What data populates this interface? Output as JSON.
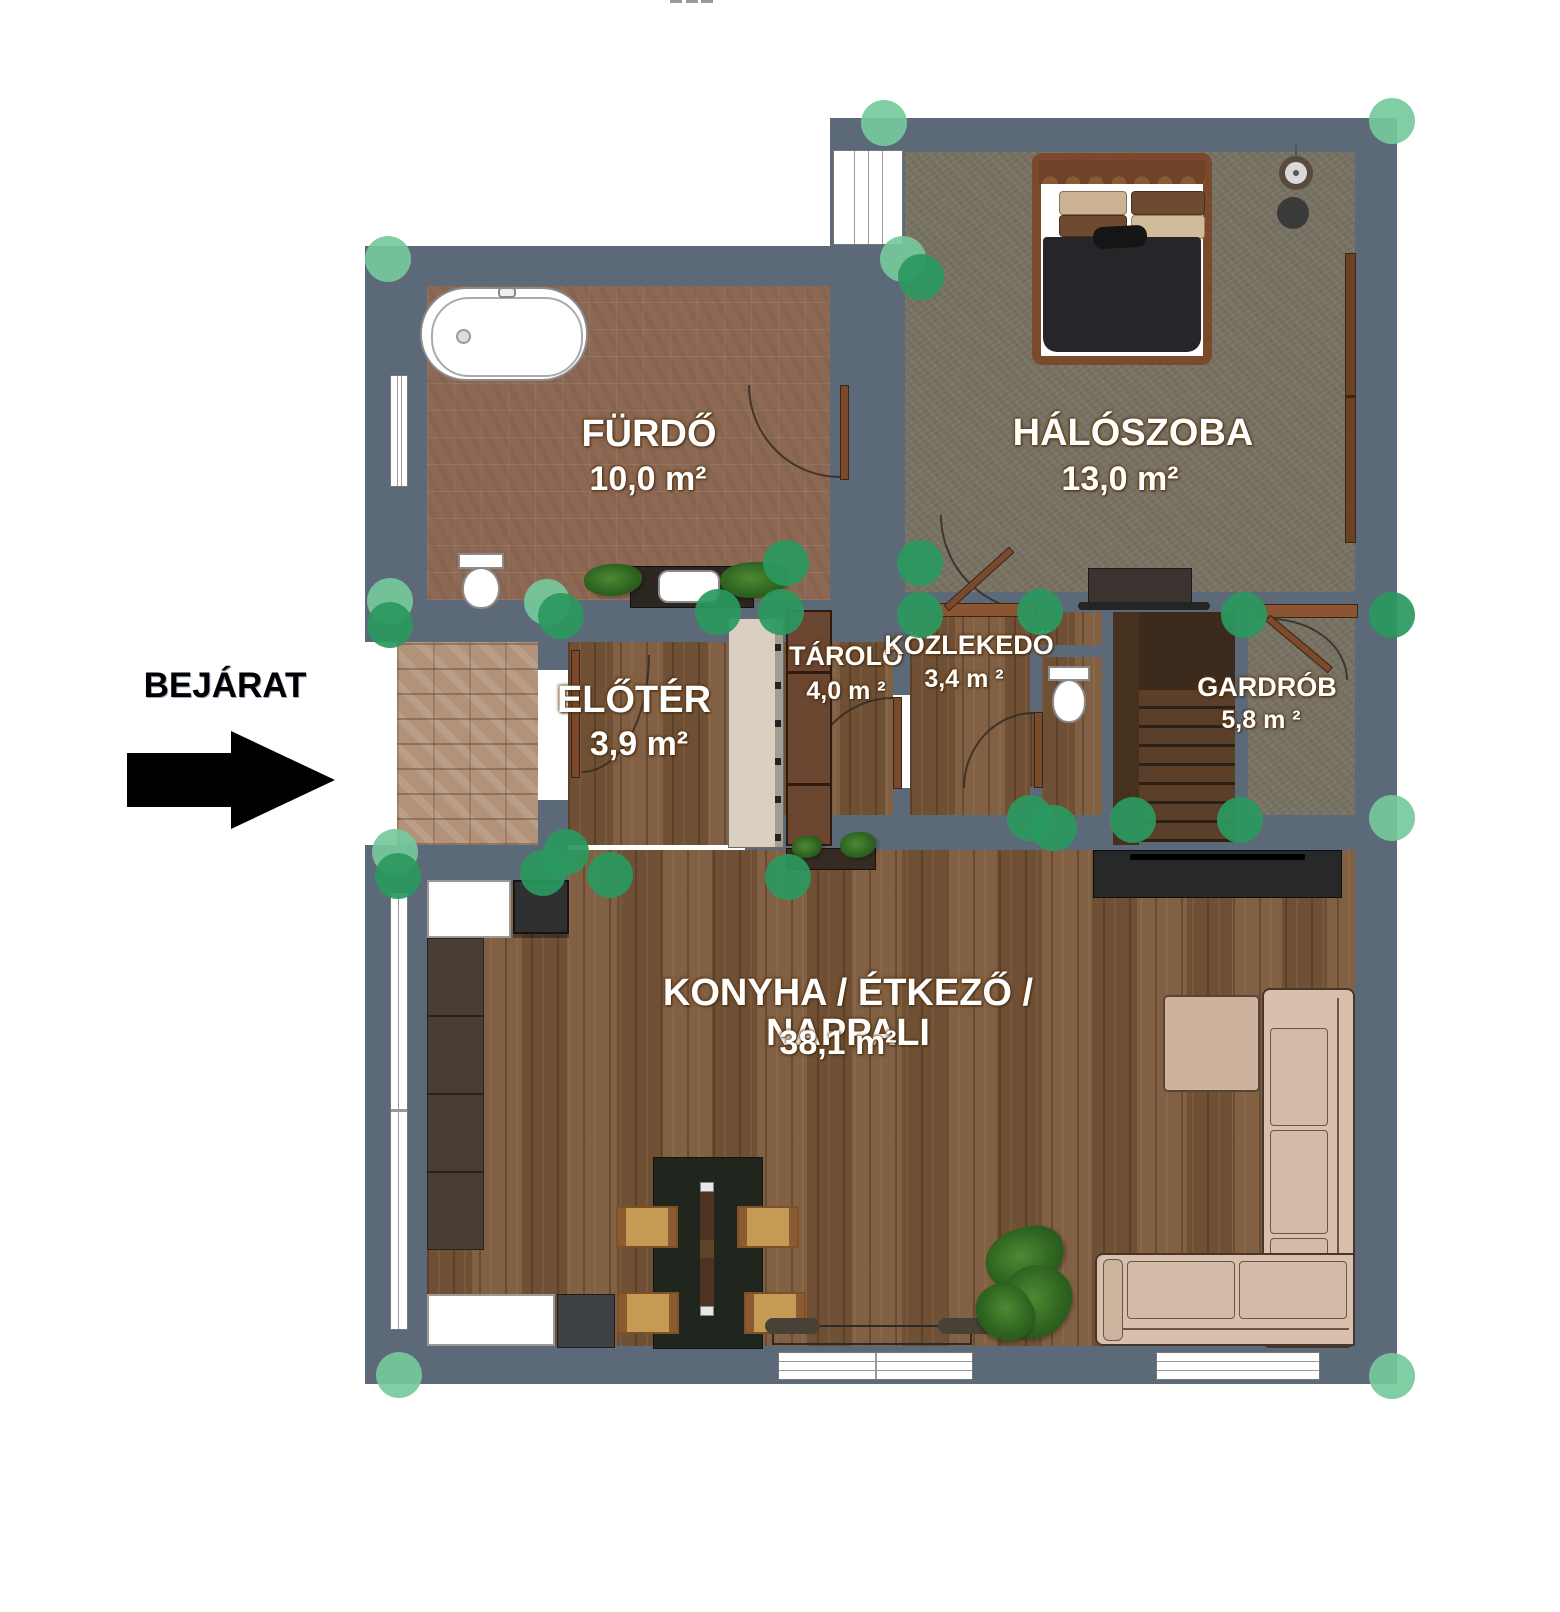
{
  "plan_title": "apartment floor plan",
  "entrance": {
    "label": "BEJÁRAT"
  },
  "rooms": {
    "furdo": {
      "name": "FÜRDŐ",
      "area": "10,0 m²"
    },
    "haloszoba": {
      "name": "HÁLÓSZOBA",
      "area": "13,0 m²"
    },
    "eloter": {
      "name": "ELŐTÉR",
      "area": "3,9 m²"
    },
    "tarolo": {
      "name": "TÁROLÓ",
      "area": "4,0 m ²"
    },
    "kozlekedo": {
      "name": "KÖZLEKEDŐ",
      "area": "3,4 m ²"
    },
    "gardrob": {
      "name": "GARDRÓB",
      "area": "5,8 m ²"
    },
    "nappali": {
      "name": "KONYHA / ÉTKEZŐ / NAPPALI",
      "area": "38,1 m²"
    }
  },
  "colors": {
    "wall": "#5c6978",
    "marker_dark": "rgba(42,153,95,0.92)",
    "marker_light": "rgba(118,201,156,0.92)",
    "wood_floor": "#7c5a3c",
    "tile_floor": "#8d6953",
    "olive_floor": "#787263",
    "stone_floor": "#b2937a",
    "arrow": "#000000"
  },
  "markers": {
    "points": [
      {
        "x": 884,
        "y": 123,
        "tone": "light"
      },
      {
        "x": 1392,
        "y": 121,
        "tone": "light"
      },
      {
        "x": 388,
        "y": 259,
        "tone": "light"
      },
      {
        "x": 903,
        "y": 259,
        "tone": "light"
      },
      {
        "x": 921,
        "y": 277,
        "tone": "dark"
      },
      {
        "x": 390,
        "y": 601,
        "tone": "light"
      },
      {
        "x": 390,
        "y": 625,
        "tone": "dark"
      },
      {
        "x": 547,
        "y": 602,
        "tone": "light"
      },
      {
        "x": 561,
        "y": 616,
        "tone": "dark"
      },
      {
        "x": 718,
        "y": 612,
        "tone": "dark"
      },
      {
        "x": 781,
        "y": 612,
        "tone": "dark"
      },
      {
        "x": 786,
        "y": 563,
        "tone": "dark"
      },
      {
        "x": 920,
        "y": 563,
        "tone": "dark"
      },
      {
        "x": 920,
        "y": 615,
        "tone": "dark"
      },
      {
        "x": 1040,
        "y": 612,
        "tone": "dark"
      },
      {
        "x": 1244,
        "y": 615,
        "tone": "dark"
      },
      {
        "x": 1392,
        "y": 615,
        "tone": "dark"
      },
      {
        "x": 1030,
        "y": 818,
        "tone": "dark"
      },
      {
        "x": 1054,
        "y": 828,
        "tone": "dark"
      },
      {
        "x": 1133,
        "y": 820,
        "tone": "dark"
      },
      {
        "x": 1240,
        "y": 820,
        "tone": "dark"
      },
      {
        "x": 1392,
        "y": 818,
        "tone": "light"
      },
      {
        "x": 395,
        "y": 852,
        "tone": "light"
      },
      {
        "x": 398,
        "y": 876,
        "tone": "dark"
      },
      {
        "x": 543,
        "y": 873,
        "tone": "dark"
      },
      {
        "x": 566,
        "y": 852,
        "tone": "dark"
      },
      {
        "x": 610,
        "y": 875,
        "tone": "dark"
      },
      {
        "x": 788,
        "y": 877,
        "tone": "dark"
      },
      {
        "x": 399,
        "y": 1375,
        "tone": "light"
      },
      {
        "x": 1392,
        "y": 1376,
        "tone": "light"
      }
    ]
  }
}
